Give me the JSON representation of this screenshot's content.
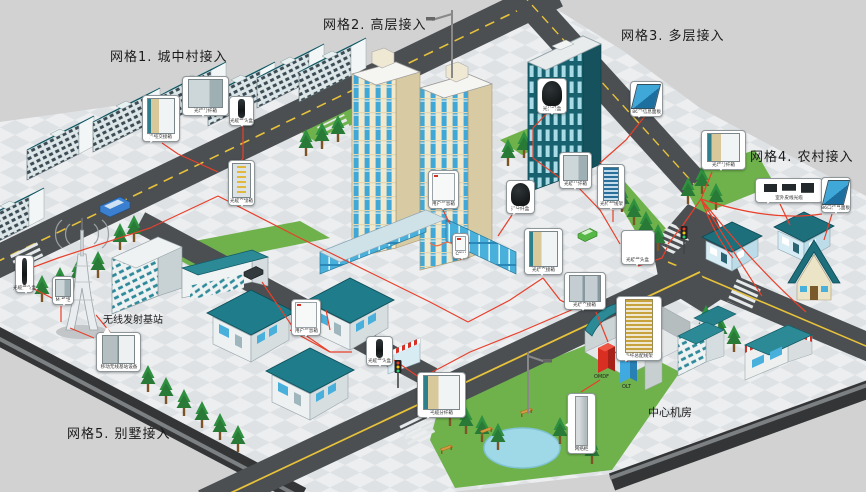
{
  "diagram": {
    "type": "isometric-network-access-diagram",
    "theme": "FTTH 光纤接入网分场景示意 (城市网格接入)",
    "colors": {
      "background": "#d2d2d2",
      "plate": "#ececef",
      "road": "#4b4f52",
      "road_line_yellow": "#e8c23a",
      "grass": "#6fb24c",
      "fiber_line": "#e8402a",
      "roof_teal": "#2a8a96",
      "wall_cream": "#f2e8cb",
      "glass_blue": "#3fa8d8",
      "omdf_red": "#d92f22",
      "olt_blue": "#3fa9e0"
    }
  },
  "grid_labels": [
    {
      "text": "网格1. 城中村接入",
      "x": 110,
      "y": 46
    },
    {
      "text": "网格2. 高层接入",
      "x": 323,
      "y": 14
    },
    {
      "text": "网格3. 多层接入",
      "x": 621,
      "y": 25
    },
    {
      "text": "网格4. 农村接入",
      "x": 750,
      "y": 146
    },
    {
      "text": "网格5. 别墅接入",
      "x": 67,
      "y": 423
    }
  ],
  "site_labels": [
    {
      "text": "无线发射基站",
      "x": 103,
      "y": 311
    },
    {
      "text": "中心机房",
      "x": 648,
      "y": 404
    }
  ],
  "central_office": {
    "name": "中心机房",
    "racks": [
      "OMDF",
      "OLT"
    ]
  },
  "callouts": [
    {
      "id": "g1-cross",
      "label": "光缆交接箱",
      "icon": "cabinet-open"
    },
    {
      "id": "g1-dist",
      "label": "光缆分纤箱",
      "icon": "cabinet"
    },
    {
      "id": "g1-splice",
      "label": "光缆接头盒",
      "icon": "closure-v"
    },
    {
      "id": "g1-street",
      "label": "光缆交接箱",
      "icon": "cabinet-fiber"
    },
    {
      "id": "g2-userbox",
      "label": "用户信息箱",
      "icon": "white-box"
    },
    {
      "id": "g2-onu",
      "label": "ONU",
      "icon": "white-box"
    },
    {
      "id": "g2-split",
      "label": "光分纤盒",
      "icon": "closure-dome"
    },
    {
      "id": "center-cross",
      "label": "光缆交接箱",
      "icon": "cabinet-open"
    },
    {
      "id": "ne-dist",
      "label": "光缆分纤箱",
      "icon": "cabinet"
    },
    {
      "id": "ne-odf",
      "label": "光纤配线架",
      "icon": "rack-blue"
    },
    {
      "id": "e-splice",
      "label": "光缆接头盒",
      "icon": "closure-h"
    },
    {
      "id": "s-cross",
      "label": "光缆交接箱",
      "icon": "cabinet-double"
    },
    {
      "id": "room-odf",
      "label": "光纤总配线架",
      "icon": "rack-fiber"
    },
    {
      "id": "g3-panel",
      "label": "86口信息面板",
      "icon": "panel-blue"
    },
    {
      "id": "g3-split",
      "label": "光分纤盒",
      "icon": "closure-dome"
    },
    {
      "id": "g4-dist",
      "label": "光缆分纤箱",
      "icon": "cabinet-open"
    },
    {
      "id": "g4-drop",
      "label": "室外皮线光缆",
      "icon": "tools"
    },
    {
      "id": "g4-panel",
      "label": "86口信息面板",
      "icon": "panel-blue"
    },
    {
      "id": "w-splice",
      "label": "光缆接头盒",
      "icon": "closure-v"
    },
    {
      "id": "w-cab",
      "label": "M-机柜",
      "icon": "cabinet"
    },
    {
      "id": "bts-equip",
      "label": "移动无线基站设备",
      "icon": "bts"
    },
    {
      "id": "v-userbox",
      "label": "用户信息箱",
      "icon": "white-box"
    },
    {
      "id": "v-splice",
      "label": "光缆接头盒",
      "icon": "closure-v"
    },
    {
      "id": "sw-dist",
      "label": "光缆分纤箱",
      "icon": "cabinet-open"
    },
    {
      "id": "pond-cab",
      "label": "网络柜",
      "icon": "cabinet-tall"
    }
  ]
}
